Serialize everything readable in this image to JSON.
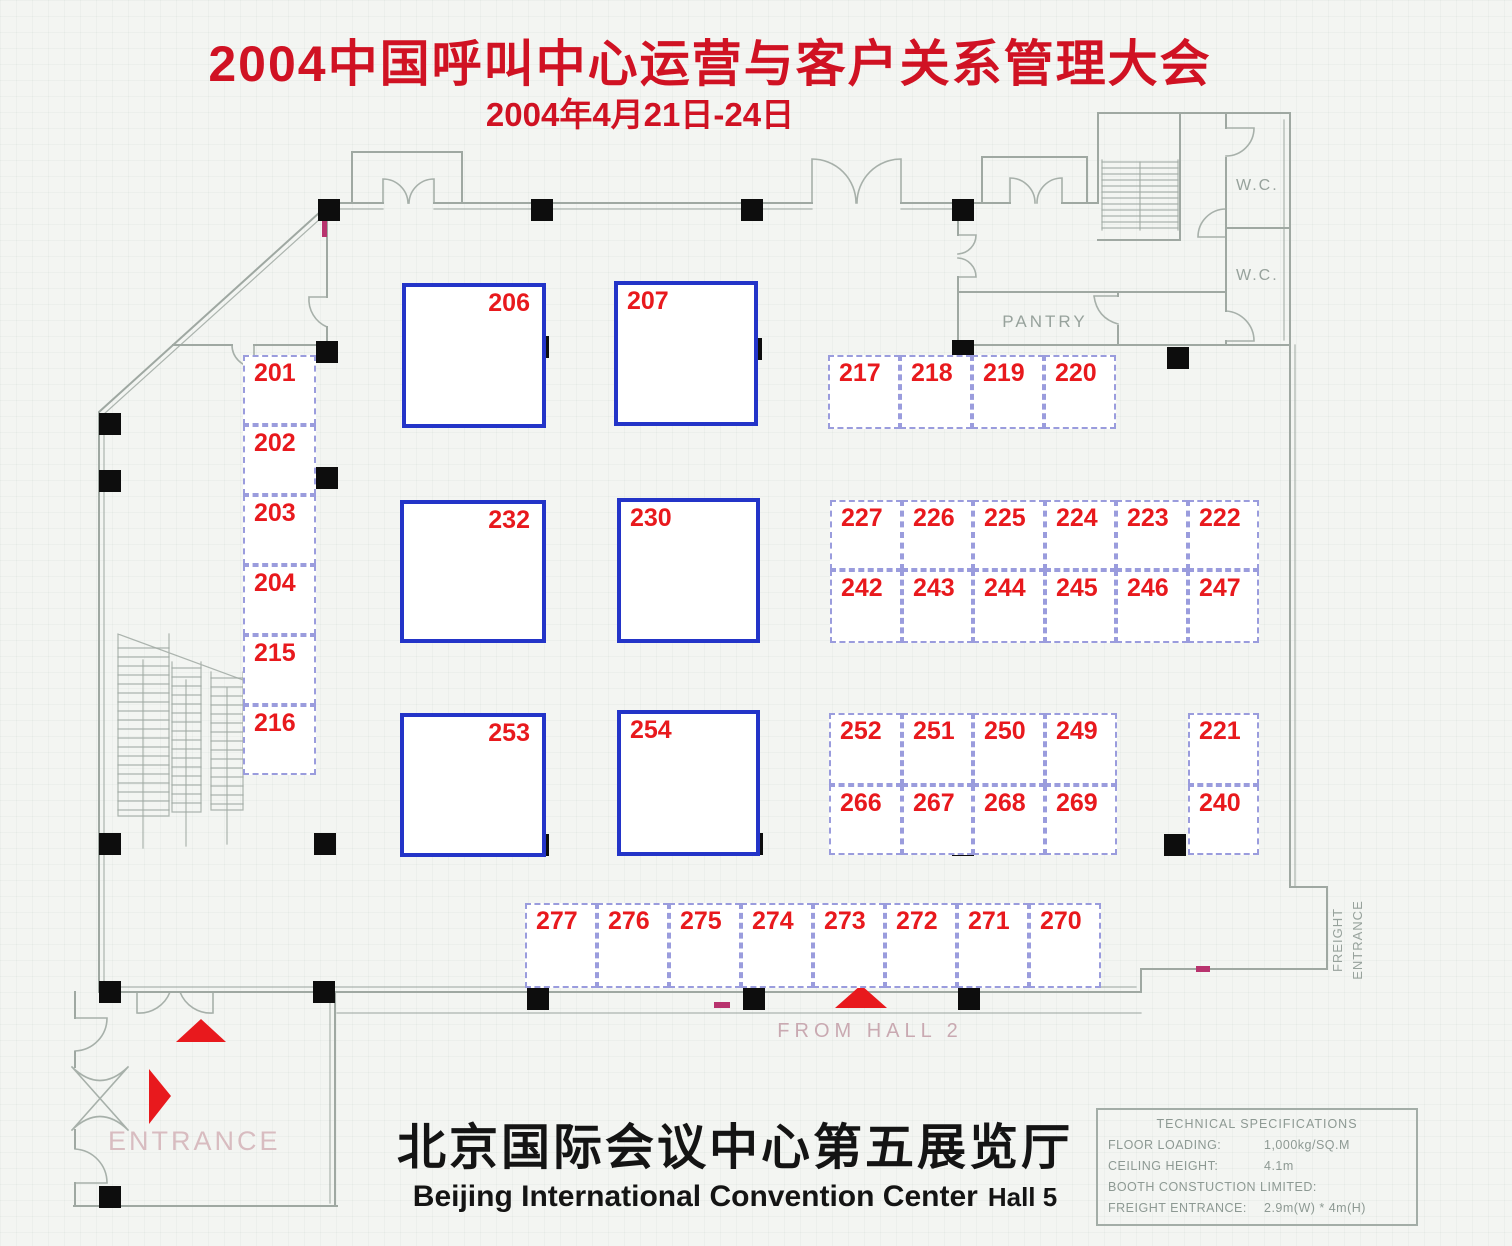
{
  "title": {
    "main": "2004中国呼叫中心运营与客户关系管理大会",
    "date": "2004年4月21日-24日"
  },
  "footer": {
    "venue_cn": "北京国际会议中心第五展览厅",
    "venue_en": "Beijing International Convention Center",
    "hall": "Hall 5"
  },
  "labels": {
    "wc1": "W.C.",
    "wc2": "W.C.",
    "pantry": "PANTRY",
    "from_hall": "FROM HALL 2",
    "entrance": "ENTRANCE",
    "freight_entrance": "FREIGHT ENTRANCE"
  },
  "specs": {
    "title": "TECHNICAL SPECIFICATIONS",
    "rows": [
      {
        "label": "FLOOR LOADING:",
        "value": "1,000kg/SQ.M"
      },
      {
        "label": "CEILING HEIGHT:",
        "value": "4.1m"
      },
      {
        "label": "BOOTH CONSTUCTION LIMITED:",
        "value": ""
      },
      {
        "label": "FREIGHT ENTRANCE:",
        "value": "2.9m(W) * 4m(H)"
      }
    ]
  },
  "booths": [
    {
      "num": "201",
      "x": 243,
      "y": 355,
      "w": 73,
      "h": 70,
      "size": "small",
      "numpos": "tl"
    },
    {
      "num": "202",
      "x": 243,
      "y": 425,
      "w": 73,
      "h": 70,
      "size": "small",
      "numpos": "tl"
    },
    {
      "num": "203",
      "x": 243,
      "y": 495,
      "w": 73,
      "h": 70,
      "size": "small",
      "numpos": "tl"
    },
    {
      "num": "204",
      "x": 243,
      "y": 565,
      "w": 73,
      "h": 70,
      "size": "small",
      "numpos": "tl"
    },
    {
      "num": "215",
      "x": 243,
      "y": 635,
      "w": 73,
      "h": 70,
      "size": "small",
      "numpos": "tl"
    },
    {
      "num": "216",
      "x": 243,
      "y": 705,
      "w": 73,
      "h": 70,
      "size": "small",
      "numpos": "tl"
    },
    {
      "num": "206",
      "x": 402,
      "y": 283,
      "w": 144,
      "h": 145,
      "size": "large",
      "numpos": "tr"
    },
    {
      "num": "207",
      "x": 614,
      "y": 281,
      "w": 144,
      "h": 145,
      "size": "large",
      "numpos": "tl"
    },
    {
      "num": "232",
      "x": 400,
      "y": 500,
      "w": 146,
      "h": 143,
      "size": "large",
      "numpos": "tr"
    },
    {
      "num": "230",
      "x": 617,
      "y": 498,
      "w": 143,
      "h": 145,
      "size": "large",
      "numpos": "tl"
    },
    {
      "num": "253",
      "x": 400,
      "y": 713,
      "w": 146,
      "h": 144,
      "size": "large",
      "numpos": "tr"
    },
    {
      "num": "254",
      "x": 617,
      "y": 710,
      "w": 143,
      "h": 146,
      "size": "large",
      "numpos": "tl"
    },
    {
      "num": "217",
      "x": 828,
      "y": 355,
      "w": 72,
      "h": 74,
      "size": "small",
      "numpos": "tl"
    },
    {
      "num": "218",
      "x": 900,
      "y": 355,
      "w": 72,
      "h": 74,
      "size": "small",
      "numpos": "tl"
    },
    {
      "num": "219",
      "x": 972,
      "y": 355,
      "w": 72,
      "h": 74,
      "size": "small",
      "numpos": "tl"
    },
    {
      "num": "220",
      "x": 1044,
      "y": 355,
      "w": 72,
      "h": 74,
      "size": "small",
      "numpos": "tl"
    },
    {
      "num": "227",
      "x": 830,
      "y": 500,
      "w": 72,
      "h": 70,
      "size": "small",
      "numpos": "tl"
    },
    {
      "num": "226",
      "x": 902,
      "y": 500,
      "w": 71,
      "h": 70,
      "size": "small",
      "numpos": "tl"
    },
    {
      "num": "225",
      "x": 973,
      "y": 500,
      "w": 72,
      "h": 70,
      "size": "small",
      "numpos": "tl"
    },
    {
      "num": "224",
      "x": 1045,
      "y": 500,
      "w": 71,
      "h": 70,
      "size": "small",
      "numpos": "tl"
    },
    {
      "num": "223",
      "x": 1116,
      "y": 500,
      "w": 72,
      "h": 70,
      "size": "small",
      "numpos": "tl"
    },
    {
      "num": "222",
      "x": 1188,
      "y": 500,
      "w": 71,
      "h": 70,
      "size": "small",
      "numpos": "tl"
    },
    {
      "num": "242",
      "x": 830,
      "y": 570,
      "w": 72,
      "h": 73,
      "size": "small",
      "numpos": "tl"
    },
    {
      "num": "243",
      "x": 902,
      "y": 570,
      "w": 71,
      "h": 73,
      "size": "small",
      "numpos": "tl"
    },
    {
      "num": "244",
      "x": 973,
      "y": 570,
      "w": 72,
      "h": 73,
      "size": "small",
      "numpos": "tl"
    },
    {
      "num": "245",
      "x": 1045,
      "y": 570,
      "w": 71,
      "h": 73,
      "size": "small",
      "numpos": "tl"
    },
    {
      "num": "246",
      "x": 1116,
      "y": 570,
      "w": 72,
      "h": 73,
      "size": "small",
      "numpos": "tl"
    },
    {
      "num": "247",
      "x": 1188,
      "y": 570,
      "w": 71,
      "h": 73,
      "size": "small",
      "numpos": "tl"
    },
    {
      "num": "252",
      "x": 829,
      "y": 713,
      "w": 73,
      "h": 72,
      "size": "small",
      "numpos": "tl"
    },
    {
      "num": "251",
      "x": 902,
      "y": 713,
      "w": 71,
      "h": 72,
      "size": "small",
      "numpos": "tl"
    },
    {
      "num": "250",
      "x": 973,
      "y": 713,
      "w": 72,
      "h": 72,
      "size": "small",
      "numpos": "tl"
    },
    {
      "num": "249",
      "x": 1045,
      "y": 713,
      "w": 72,
      "h": 72,
      "size": "small",
      "numpos": "tl"
    },
    {
      "num": "266",
      "x": 829,
      "y": 785,
      "w": 73,
      "h": 70,
      "size": "small",
      "numpos": "tl"
    },
    {
      "num": "267",
      "x": 902,
      "y": 785,
      "w": 71,
      "h": 70,
      "size": "small",
      "numpos": "tl"
    },
    {
      "num": "268",
      "x": 973,
      "y": 785,
      "w": 72,
      "h": 70,
      "size": "small",
      "numpos": "tl"
    },
    {
      "num": "269",
      "x": 1045,
      "y": 785,
      "w": 72,
      "h": 70,
      "size": "small",
      "numpos": "tl"
    },
    {
      "num": "221",
      "x": 1188,
      "y": 713,
      "w": 71,
      "h": 72,
      "size": "small",
      "numpos": "tl"
    },
    {
      "num": "240",
      "x": 1188,
      "y": 785,
      "w": 71,
      "h": 70,
      "size": "small",
      "numpos": "tl"
    },
    {
      "num": "277",
      "x": 525,
      "y": 903,
      "w": 72,
      "h": 85,
      "size": "small",
      "numpos": "tl"
    },
    {
      "num": "276",
      "x": 597,
      "y": 903,
      "w": 72,
      "h": 85,
      "size": "small",
      "numpos": "tl"
    },
    {
      "num": "275",
      "x": 669,
      "y": 903,
      "w": 72,
      "h": 85,
      "size": "small",
      "numpos": "tl"
    },
    {
      "num": "274",
      "x": 741,
      "y": 903,
      "w": 72,
      "h": 85,
      "size": "small",
      "numpos": "tl"
    },
    {
      "num": "273",
      "x": 813,
      "y": 903,
      "w": 72,
      "h": 85,
      "size": "small",
      "numpos": "tl"
    },
    {
      "num": "272",
      "x": 885,
      "y": 903,
      "w": 72,
      "h": 85,
      "size": "small",
      "numpos": "tl"
    },
    {
      "num": "271",
      "x": 957,
      "y": 903,
      "w": 72,
      "h": 85,
      "size": "small",
      "numpos": "tl"
    },
    {
      "num": "270",
      "x": 1029,
      "y": 903,
      "w": 72,
      "h": 85,
      "size": "small",
      "numpos": "tl"
    }
  ],
  "colors": {
    "title_red": "#d01223",
    "booth_number_red": "#e8191d",
    "large_booth_blue": "#2334c8",
    "small_booth_border": "#9a9cdd",
    "wall_gray": "#9fa8a2",
    "label_gray": "#97a29c",
    "entrance_pink": "#d8bcc0",
    "hall_label_pink": "#c9a9b1",
    "column_black": "#0d0d0d",
    "tick_magenta": "#b8336e"
  }
}
